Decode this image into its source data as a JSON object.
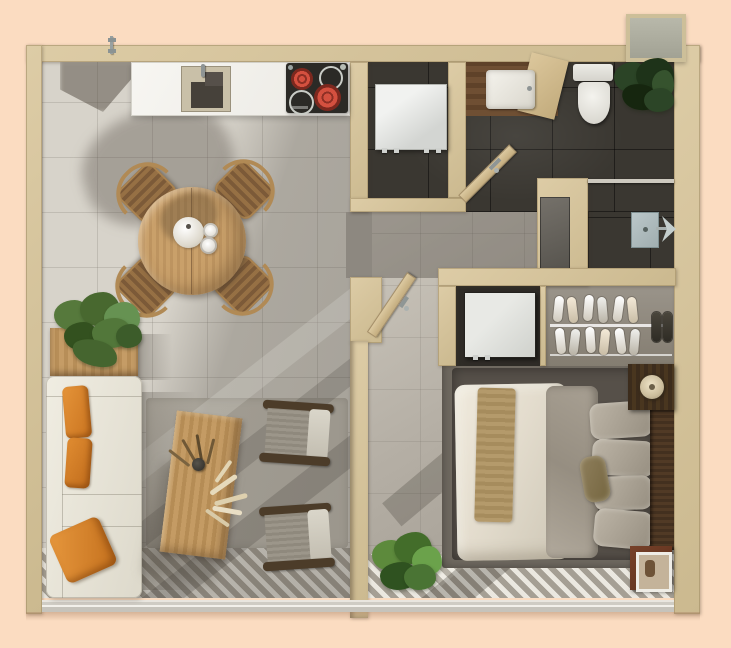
{
  "scene": {
    "kind": "apartment-floor-plan-3d-render",
    "view": "top-down",
    "background_color": "#fbdcc1"
  },
  "palette": {
    "background": "#fbdcc1",
    "wall_tan": "#d5c49d",
    "light_floor": "#d7d3ca",
    "gray_floor": "#9b968e",
    "dark_tile": "#3a3731",
    "closet_floor": "#8e877b",
    "wood_light": "#c9a06a",
    "wood_dark": "#43301f",
    "counter_white": "#f4f3ef",
    "burner_red": "#d4503f",
    "cushion_orange": "#dd8a33",
    "textile_white": "#ece7da",
    "textile_gray": "#a29a8d",
    "greenery": "#4f7a35",
    "greenery_dark": "#24381d",
    "shower_tray": "#b2bec0",
    "deck_stripe_light": "#ebe8e0",
    "deck_stripe_dark": "#a59f94"
  },
  "rooms": [
    {
      "id": "kitchen",
      "label": "open kitchen"
    },
    {
      "id": "dining",
      "label": "dining area"
    },
    {
      "id": "living",
      "label": "living area"
    },
    {
      "id": "bathroom",
      "label": "bathroom with vanity and toilet"
    },
    {
      "id": "laundry_niche",
      "label": "laundry niche"
    },
    {
      "id": "shower_room",
      "label": "shower room"
    },
    {
      "id": "corridor",
      "label": "corridor"
    },
    {
      "id": "wardrobe",
      "label": "open shoe wardrobe"
    },
    {
      "id": "bedroom",
      "label": "bedroom"
    },
    {
      "id": "deck",
      "label": "striped deck strip along window wall"
    }
  ],
  "items": {
    "counter": {
      "label": "kitchen counter"
    },
    "sink": {
      "label": "kitchen sink"
    },
    "cooktop": {
      "label": "cooktop, two burners glowing red"
    },
    "dining_table": {
      "label": "round wooden dining table"
    },
    "dining_chair": {
      "label": "wooden dining chair"
    },
    "tea_set": {
      "label": "white teapot and cups"
    },
    "console": {
      "label": "wooden console shelf"
    },
    "console_plant": {
      "label": "potted green plant"
    },
    "sofa": {
      "label": "white sofa with orange cushions"
    },
    "rug": {
      "label": "light area rug"
    },
    "coffee_table": {
      "label": "wooden coffee table"
    },
    "pampas": {
      "label": "dried pampas arrangement"
    },
    "armchair": {
      "label": "gray lounge armchair"
    },
    "washer": {
      "label": "washing machine"
    },
    "vanity": {
      "label": "vanity with white basin"
    },
    "toilet": {
      "label": "toilet"
    },
    "bath_plant": {
      "label": "dark fiddle-leaf plant"
    },
    "bath_door": {
      "label": "open bathroom door"
    },
    "interior_door": {
      "label": "open interior door"
    },
    "entry_handle": {
      "label": "door handle on top wall"
    },
    "ac_unit": {
      "label": "outdoor AC unit"
    },
    "shower": {
      "label": "walk-in shower with tray and head"
    },
    "shower_panel": {
      "label": "dark shower panel"
    },
    "sneakers": {
      "label": "white sneakers on wardrobe shelves"
    },
    "slippers": {
      "label": "dark slippers"
    },
    "appliance": {
      "label": "white appliance in niche"
    },
    "bed": {
      "label": "double bed with white duvet"
    },
    "throw": {
      "label": "tan throw blanket"
    },
    "gray_blanket": {
      "label": "gray folded blanket"
    },
    "pillows": {
      "label": "gray pillows"
    },
    "headboard": {
      "label": "dark wood headboard"
    },
    "nightstand": {
      "label": "dark wood nightstand"
    },
    "lamp": {
      "label": "round table lamp"
    },
    "frame_stand": {
      "label": "small stand with picture frame"
    },
    "bedroom_plant": {
      "label": "green plant"
    },
    "window_wall": {
      "label": "glazed window wall"
    },
    "deck_stripes": {
      "label": "striped decking"
    }
  }
}
